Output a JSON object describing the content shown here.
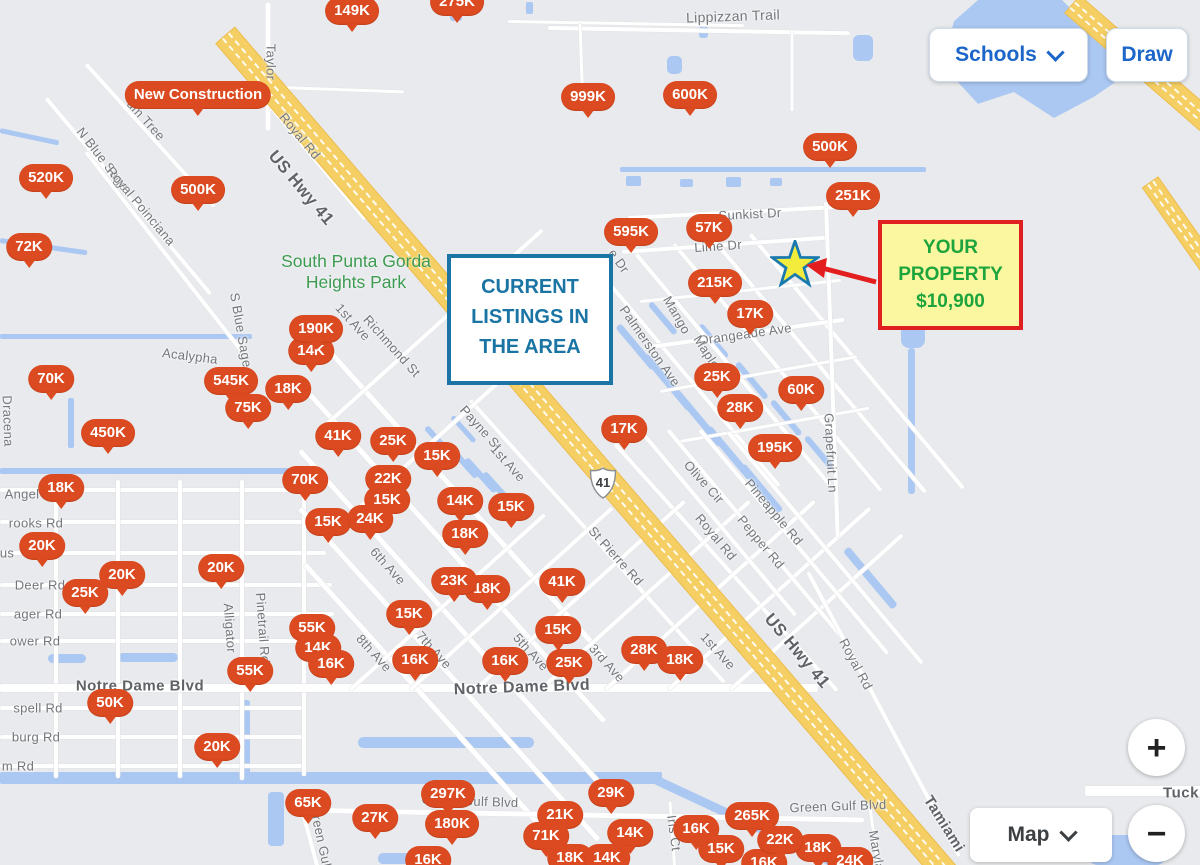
{
  "controls": {
    "schools_label": "Schools",
    "draw_label": "Draw",
    "map_type_label": "Map",
    "zoom_in_label": "+",
    "zoom_out_label": "−"
  },
  "annotations": {
    "current_listings": {
      "line1": "CURRENT",
      "line2": "LISTINGS IN",
      "line3": "THE AREA"
    },
    "your_property": {
      "line1": "YOUR",
      "line2": "PROPERTY",
      "line3": "$10,900"
    }
  },
  "park_label": {
    "line1": "South Punta Gorda",
    "line2": "Heights Park"
  },
  "highway_shield": "41",
  "pins": [
    {
      "label": "275K",
      "x": 457,
      "y": 2
    },
    {
      "label": "149K",
      "x": 352,
      "y": 11
    },
    {
      "label": "New Construction",
      "x": 198,
      "y": 95
    },
    {
      "label": "999K",
      "x": 588,
      "y": 97
    },
    {
      "label": "600K",
      "x": 690,
      "y": 95
    },
    {
      "label": "500K",
      "x": 830,
      "y": 147
    },
    {
      "label": "251K",
      "x": 853,
      "y": 196
    },
    {
      "label": "520K",
      "x": 46,
      "y": 178
    },
    {
      "label": "500K",
      "x": 198,
      "y": 190
    },
    {
      "label": "72K",
      "x": 29,
      "y": 247
    },
    {
      "label": "595K",
      "x": 631,
      "y": 232
    },
    {
      "label": "57K",
      "x": 709,
      "y": 228
    },
    {
      "label": "215K",
      "x": 715,
      "y": 283
    },
    {
      "label": "17K",
      "x": 750,
      "y": 314
    },
    {
      "label": "70K",
      "x": 51,
      "y": 379
    },
    {
      "label": "14K",
      "x": 311,
      "y": 351
    },
    {
      "label": "190K",
      "x": 316,
      "y": 329
    },
    {
      "label": "545K",
      "x": 231,
      "y": 381
    },
    {
      "label": "18K",
      "x": 288,
      "y": 389
    },
    {
      "label": "75K",
      "x": 248,
      "y": 408
    },
    {
      "label": "25K",
      "x": 717,
      "y": 377
    },
    {
      "label": "28K",
      "x": 740,
      "y": 408
    },
    {
      "label": "60K",
      "x": 801,
      "y": 390
    },
    {
      "label": "450K",
      "x": 108,
      "y": 433
    },
    {
      "label": "41K",
      "x": 338,
      "y": 436
    },
    {
      "label": "25K",
      "x": 393,
      "y": 441
    },
    {
      "label": "15K",
      "x": 437,
      "y": 456
    },
    {
      "label": "17K",
      "x": 624,
      "y": 429
    },
    {
      "label": "195K",
      "x": 775,
      "y": 448
    },
    {
      "label": "18K",
      "x": 61,
      "y": 488
    },
    {
      "label": "70K",
      "x": 305,
      "y": 480
    },
    {
      "label": "22K",
      "x": 388,
      "y": 479
    },
    {
      "label": "15K",
      "x": 387,
      "y": 500
    },
    {
      "label": "14K",
      "x": 460,
      "y": 501
    },
    {
      "label": "15K",
      "x": 511,
      "y": 507
    },
    {
      "label": "15K",
      "x": 328,
      "y": 522
    },
    {
      "label": "24K",
      "x": 370,
      "y": 519
    },
    {
      "label": "18K",
      "x": 465,
      "y": 534
    },
    {
      "label": "20K",
      "x": 42,
      "y": 546
    },
    {
      "label": "20K",
      "x": 221,
      "y": 568
    },
    {
      "label": "20K",
      "x": 122,
      "y": 575
    },
    {
      "label": "25K",
      "x": 85,
      "y": 593
    },
    {
      "label": "18K",
      "x": 487,
      "y": 589
    },
    {
      "label": "23K",
      "x": 454,
      "y": 581
    },
    {
      "label": "41K",
      "x": 562,
      "y": 582
    },
    {
      "label": "15K",
      "x": 409,
      "y": 614
    },
    {
      "label": "15K",
      "x": 558,
      "y": 630
    },
    {
      "label": "55K",
      "x": 312,
      "y": 628
    },
    {
      "label": "14K",
      "x": 318,
      "y": 648
    },
    {
      "label": "16K",
      "x": 331,
      "y": 664
    },
    {
      "label": "16K",
      "x": 415,
      "y": 660
    },
    {
      "label": "16K",
      "x": 505,
      "y": 661
    },
    {
      "label": "25K",
      "x": 569,
      "y": 663
    },
    {
      "label": "28K",
      "x": 644,
      "y": 650
    },
    {
      "label": "18K",
      "x": 680,
      "y": 660
    },
    {
      "label": "55K",
      "x": 250,
      "y": 671
    },
    {
      "label": "50K",
      "x": 110,
      "y": 703
    },
    {
      "label": "20K",
      "x": 217,
      "y": 747
    },
    {
      "label": "65K",
      "x": 308,
      "y": 803
    },
    {
      "label": "27K",
      "x": 375,
      "y": 818
    },
    {
      "label": "297K",
      "x": 448,
      "y": 794
    },
    {
      "label": "180K",
      "x": 452,
      "y": 824
    },
    {
      "label": "16K",
      "x": 428,
      "y": 860
    },
    {
      "label": "21K",
      "x": 560,
      "y": 815
    },
    {
      "label": "71K",
      "x": 546,
      "y": 836
    },
    {
      "label": "29K",
      "x": 611,
      "y": 793
    },
    {
      "label": "14K",
      "x": 630,
      "y": 833
    },
    {
      "label": "18K",
      "x": 570,
      "y": 858
    },
    {
      "label": "14K",
      "x": 607,
      "y": 858
    },
    {
      "label": "16K",
      "x": 696,
      "y": 829
    },
    {
      "label": "265K",
      "x": 752,
      "y": 816
    },
    {
      "label": "15K",
      "x": 721,
      "y": 849
    },
    {
      "label": "16K",
      "x": 764,
      "y": 863
    },
    {
      "label": "18K",
      "x": 818,
      "y": 848
    },
    {
      "label": "22K",
      "x": 780,
      "y": 840
    },
    {
      "label": "24K",
      "x": 850,
      "y": 861
    }
  ],
  "street_labels": [
    {
      "t": "Taylor",
      "x": 271,
      "y": 62,
      "r": 90
    },
    {
      "t": "Lippizzan Trail",
      "x": 733,
      "y": 16,
      "r": -2,
      "s": 14
    },
    {
      "t": "um Tree",
      "x": 146,
      "y": 120,
      "r": 48
    },
    {
      "t": "Royal Rd",
      "x": 300,
      "y": 136,
      "r": 50
    },
    {
      "t": "US Hwy 41",
      "x": 301,
      "y": 188,
      "r": 50,
      "s": 17,
      "c": "dark"
    },
    {
      "t": "N Blue Sage",
      "x": 103,
      "y": 159,
      "r": 52
    },
    {
      "t": "Royal Poinciana",
      "x": 141,
      "y": 206,
      "r": 50
    },
    {
      "t": "Dracena",
      "x": 8,
      "y": 421,
      "r": 88
    },
    {
      "t": "Acalypha",
      "x": 190,
      "y": 356,
      "r": 7
    },
    {
      "t": "S Blue Sage",
      "x": 241,
      "y": 330,
      "r": 80
    },
    {
      "t": "1st Ave",
      "x": 353,
      "y": 322,
      "r": 48
    },
    {
      "t": "Richmond St",
      "x": 392,
      "y": 346,
      "r": 48
    },
    {
      "t": "Payne St",
      "x": 481,
      "y": 428,
      "r": 48
    },
    {
      "t": "1st Ave",
      "x": 508,
      "y": 463,
      "r": 48
    },
    {
      "t": "St Pierre Rd",
      "x": 616,
      "y": 556,
      "r": 48
    },
    {
      "t": "6th Ave",
      "x": 388,
      "y": 566,
      "r": 48
    },
    {
      "t": "8th Ave",
      "x": 374,
      "y": 653,
      "r": 48
    },
    {
      "t": "7th Ave",
      "x": 434,
      "y": 650,
      "r": 48
    },
    {
      "t": "5th Ave",
      "x": 531,
      "y": 652,
      "r": 48
    },
    {
      "t": "3rd Ave",
      "x": 607,
      "y": 663,
      "r": 48
    },
    {
      "t": "1st Ave",
      "x": 718,
      "y": 651,
      "r": 48
    },
    {
      "t": "Alligator",
      "x": 230,
      "y": 628,
      "r": 86
    },
    {
      "t": "Pinetrail Rd",
      "x": 263,
      "y": 628,
      "r": 86
    },
    {
      "t": "Notre Dame Blvd",
      "x": 140,
      "y": 686,
      "s": 15,
      "c": "dark"
    },
    {
      "t": "Notre Dame Blvd",
      "x": 522,
      "y": 688,
      "r": -2,
      "s": 16,
      "c": "dark"
    },
    {
      "t": "Angel",
      "x": 22,
      "y": 494
    },
    {
      "t": "rooks Rd",
      "x": 36,
      "y": 523
    },
    {
      "t": "us",
      "x": 7,
      "y": 553
    },
    {
      "t": "Deer Rd",
      "x": 40,
      "y": 585
    },
    {
      "t": "ager Rd",
      "x": 38,
      "y": 614
    },
    {
      "t": "ower Rd",
      "x": 35,
      "y": 641
    },
    {
      "t": "spell Rd",
      "x": 38,
      "y": 708
    },
    {
      "t": "burg Rd",
      "x": 36,
      "y": 737
    },
    {
      "t": "m Rd",
      "x": 18,
      "y": 766
    },
    {
      "t": "Green Gulf",
      "x": 321,
      "y": 838,
      "r": 78
    },
    {
      "t": "Green Gulf Blvd",
      "x": 470,
      "y": 801,
      "r": 2
    },
    {
      "t": "Green Gulf Blvd",
      "x": 838,
      "y": 806,
      "r": -2
    },
    {
      "t": "Iris Ct",
      "x": 674,
      "y": 833,
      "r": 82
    },
    {
      "t": "Maryland",
      "x": 878,
      "y": 858,
      "r": 80
    },
    {
      "t": "Tamiami",
      "x": 944,
      "y": 824,
      "r": 58,
      "s": 15,
      "c": "dark"
    },
    {
      "t": "US Hwy 41",
      "x": 797,
      "y": 651,
      "r": 50,
      "s": 17,
      "c": "dark"
    },
    {
      "t": "Royal Rd",
      "x": 856,
      "y": 664,
      "r": 62
    },
    {
      "t": "Tuck",
      "x": 1181,
      "y": 793,
      "s": 15,
      "c": "dark"
    },
    {
      "t": "Sunkist Dr",
      "x": 750,
      "y": 214,
      "r": -3
    },
    {
      "t": "Lime Dr",
      "x": 718,
      "y": 246,
      "r": -4
    },
    {
      "t": "e Dr",
      "x": 619,
      "y": 261,
      "r": 55
    },
    {
      "t": "Orangeade Ave",
      "x": 745,
      "y": 334,
      "r": -8
    },
    {
      "t": "Palmerston Ave",
      "x": 650,
      "y": 346,
      "r": 55
    },
    {
      "t": "Mango",
      "x": 677,
      "y": 315,
      "r": 60
    },
    {
      "t": "Mapleton",
      "x": 712,
      "y": 360,
      "r": 57
    },
    {
      "t": "Olive Cir",
      "x": 704,
      "y": 482,
      "r": 48
    },
    {
      "t": "Pineapple Rd",
      "x": 774,
      "y": 512,
      "r": 50
    },
    {
      "t": "Pepper Rd",
      "x": 761,
      "y": 542,
      "r": 50
    },
    {
      "t": "Royal Rd",
      "x": 716,
      "y": 537,
      "r": 50
    },
    {
      "t": "Grapefruit Ln",
      "x": 831,
      "y": 453,
      "r": 87
    }
  ],
  "colors": {
    "pin": "#db4a20",
    "btn_blue": "#1b66c8",
    "map_text": "#3c4043",
    "listings": "#1a74a4",
    "prop_border": "#e02020",
    "prop_bg": "#faf7a0",
    "prop_text": "#1ea43c",
    "star_fill": "#f4ec3d",
    "star_stroke": "#1879ae",
    "arrow": "#e31e1e",
    "water": "#abc8f3",
    "hwy": "#f5cf63",
    "park": "#3d9b51",
    "label": "#73777b",
    "label_dark": "#5f6367"
  }
}
